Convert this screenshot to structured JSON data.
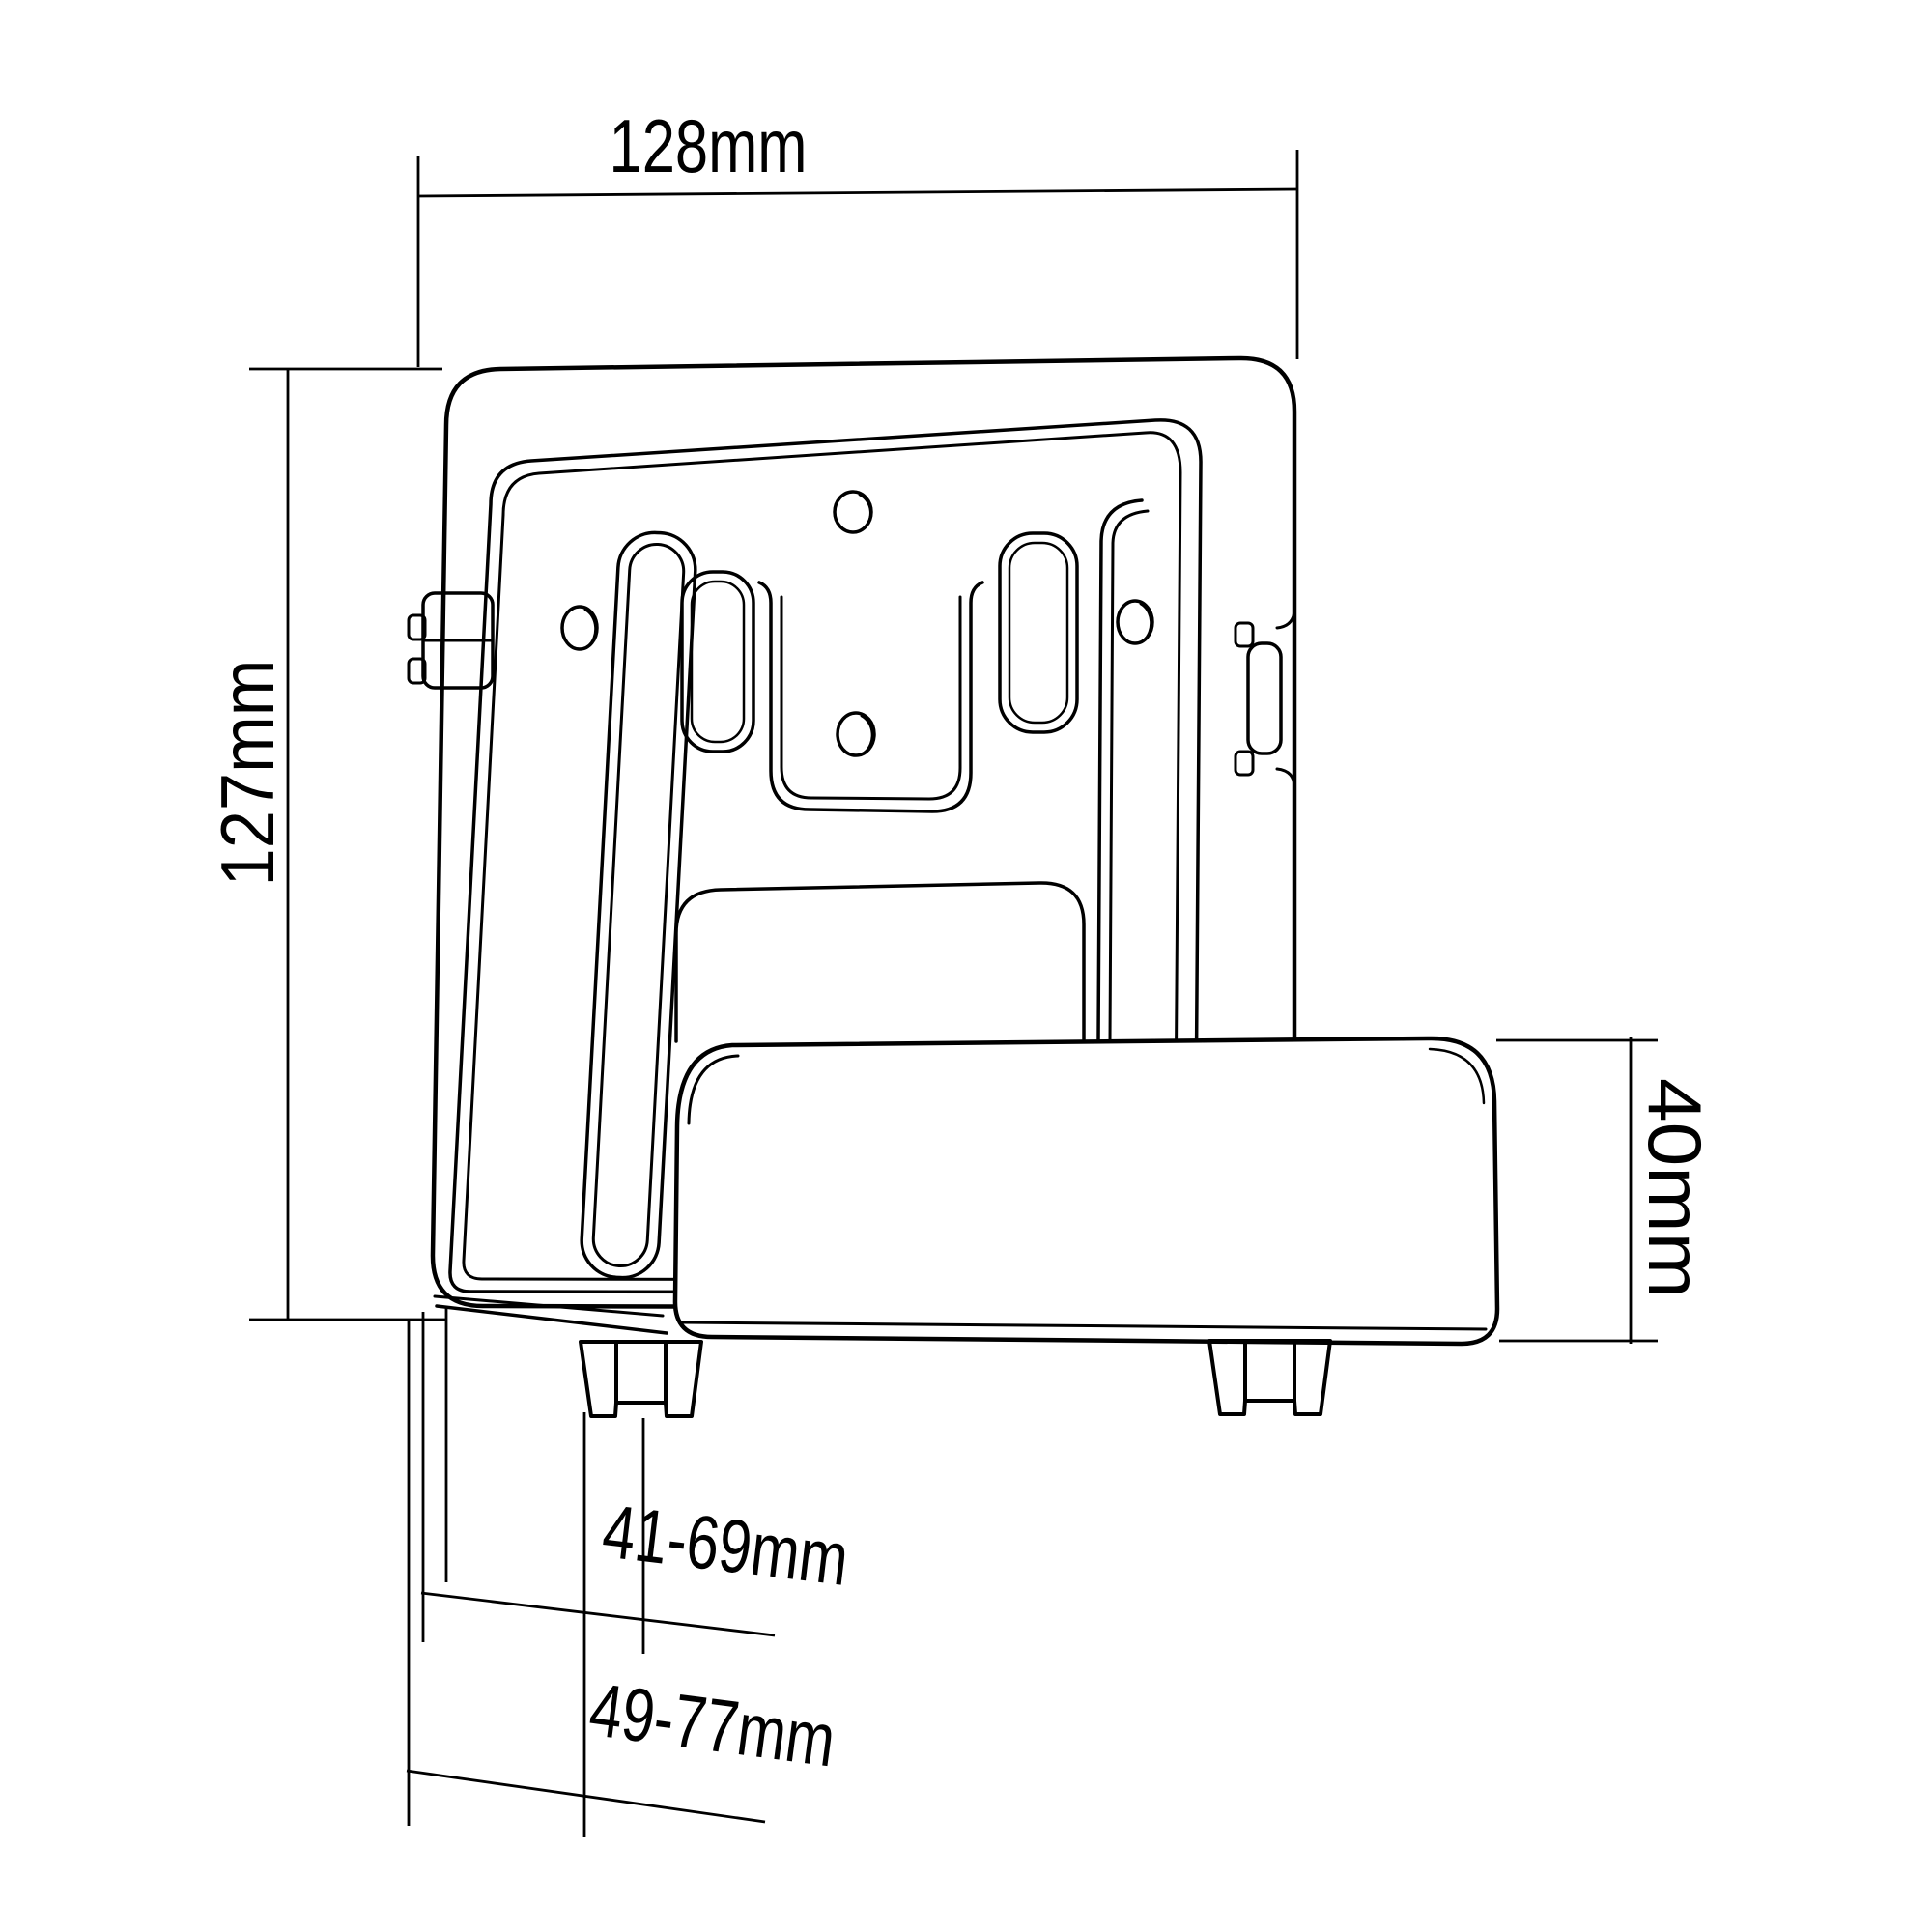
{
  "drawing": {
    "description": "Technical line drawing of an adjustable streaming-media-player / set-top-box wall mount bracket with dimension annotations",
    "colors": {
      "line": "#000000",
      "background": "#ffffff"
    },
    "dimensions": {
      "width_label": "128mm",
      "height_label": "127mm",
      "depth_label": "40mm",
      "inner_range_label": "41-69mm",
      "outer_range_label": "49-77mm"
    }
  }
}
